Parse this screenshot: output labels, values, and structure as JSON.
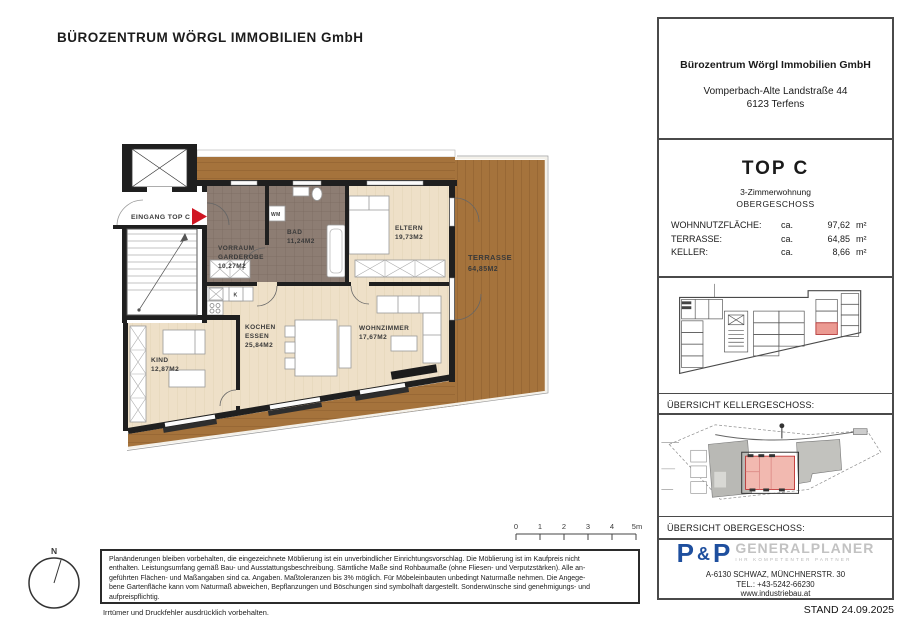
{
  "header": {
    "title": "BÜROZENTRUM WÖRGL IMMOBILIEN GmbH"
  },
  "floorplan": {
    "entrance": "EINGANG TOP C",
    "rooms": {
      "vorraum": {
        "line1": "VORRAUM",
        "line2": "GARDEROBE",
        "area": "10,27M2"
      },
      "bad": {
        "line1": "BAD",
        "area": "11,24M2"
      },
      "eltern": {
        "line1": "ELTERN",
        "area": "19,73M2"
      },
      "terrasse": {
        "line1": "TERRASSE",
        "area": "64,85M2"
      },
      "kochen": {
        "line1": "KOCHEN",
        "line2": "ESSEN",
        "area": "25,84M2"
      },
      "wohnzimmer": {
        "line1": "WOHNZIMMER",
        "area": "17,67M2"
      },
      "kind": {
        "line1": "KIND",
        "area": "12,87M2"
      }
    },
    "appliances": {
      "wm": "WM",
      "k": "K"
    }
  },
  "scalebar": {
    "labels": [
      "0",
      "1",
      "2",
      "3",
      "4",
      "5m"
    ]
  },
  "compass": {
    "north": "N"
  },
  "disclaimer": {
    "lines": [
      "Planänderungen bleiben vorbehalten, die eingezeichnete Möblierung ist ein unverbindlicher Einrichtungsvorschlag. Die Möblierung ist im Kaufpreis nicht",
      "enthalten. Leistungsumfang gemäß Bau- und Ausstattungsbeschreibung. Sämtliche Maße sind Rohbaumaße (ohne Fliesen- und Verputzstärken). Alle an-",
      "geführten Flächen- und Maßangaben sind ca. Angaben. Maßtoleranzen bis 3% möglich. Für Möbeleinbauten unbedingt Naturmaße nehmen. Die Angege-",
      "bene Gartenfläche kann vom Naturmaß abweichen, Bepflanzungen und Böschungen sind symbolhaft dargestellt. Sonderwünsche sind genehmigungs- und",
      "aufpreispflichtig."
    ],
    "note": "Irrtümer und Druckfehler ausdrücklich vorbehalten."
  },
  "panel": {
    "company": {
      "name": "Bürozentrum Wörgl Immobilien GmbH",
      "street": "Vomperbach-Alte Landstraße 44",
      "city": "6123 Terfens"
    },
    "unit": {
      "title": "TOP C",
      "type": "3-Zimmerwohnung",
      "floor": "OBERGESCHOSS",
      "areas": [
        {
          "label": "WOHNNUTZFLÄCHE:",
          "approx": "ca.",
          "value": "97,62",
          "unit": "m²"
        },
        {
          "label": "TERRASSE:",
          "approx": "ca.",
          "value": "64,85",
          "unit": "m²"
        },
        {
          "label": "KELLER:",
          "approx": "ca.",
          "value": "8,66",
          "unit": "m²"
        }
      ]
    },
    "overview_keller": "ÜBERSICHT KELLERGESCHOSS:",
    "overview_og": "ÜBERSICHT OBERGESCHOSS:",
    "pp": {
      "p1": "P",
      "amp": "&",
      "p2": "P",
      "brand": "GENERALPLANER",
      "tagline": "IHR KOMPETENTER PARTNER",
      "address": "A-6130 SCHWAZ, MÜNCHNERSTR. 30",
      "tel": "TEL.: +43-5242-66230",
      "web": "www.industriebau.at"
    },
    "stand": "STAND 24.09.2025"
  },
  "colors": {
    "pp_blue": "#1e4f9e",
    "highlight_red": "#cc2a2a",
    "terrace_wood": "#a5733c",
    "interior_wood": "#eee0c8",
    "tile_dark": "#8d7d73",
    "entrance_arrow_red": "#d01522"
  }
}
